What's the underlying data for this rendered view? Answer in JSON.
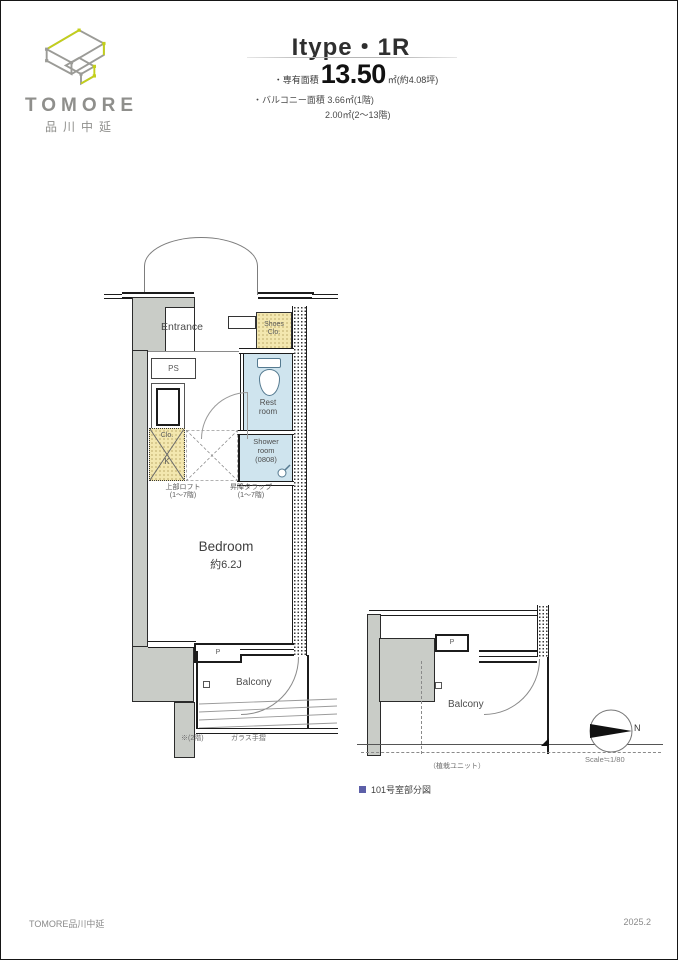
{
  "logo": {
    "brand": "TOMORE",
    "subtitle": "品川中延"
  },
  "header": {
    "title": "Itype・1R",
    "area_label": "・専有面積",
    "area_value": "13.50",
    "area_suffix": "㎡(約4.08坪)",
    "balcony_label": "・バルコニー面積",
    "balcony_value1": "3.66㎡(1階)",
    "balcony_value2": "2.00㎡(2〜13階)"
  },
  "plan": {
    "entrance": "Entrance",
    "shoes_l1": "Shoes",
    "shoes_l2": "Clo.",
    "ps": "PS",
    "rest_l1": "Rest",
    "rest_l2": "room",
    "shower_l1": "Shower",
    "shower_l2": "room",
    "shower_l3": "(0808)",
    "clo": "Clo.",
    "k": "K",
    "loft_l1": "上部ロフト",
    "loft_l2": "(1〜7階)",
    "ladder_l1": "昇降タラップ",
    "ladder_l2": "(1〜7階)",
    "bedroom": "Bedroom",
    "bedroom_size": "約6.2J",
    "pillar": "P",
    "balcony": "Balcony",
    "note_left": "※(2階)",
    "note_right": "ガラス手摺"
  },
  "partial": {
    "pillar": "P",
    "balcony": "Balcony",
    "ground_note": "（植栽ユニット）",
    "caption": "101号室部分図"
  },
  "compass": {
    "north": "N",
    "scale": "Scale≒1/80"
  },
  "footer": {
    "left": "TOMORE品川中延",
    "right": "2025.2"
  },
  "colors": {
    "accent_green": "#c3cf1b",
    "logo_gray": "#8f8f8c",
    "room_blue": "#cfe4ee",
    "closet_tan": "#f3e7af",
    "wall_gray": "#c9ccc7",
    "caption_purple": "#5c5fa8"
  }
}
